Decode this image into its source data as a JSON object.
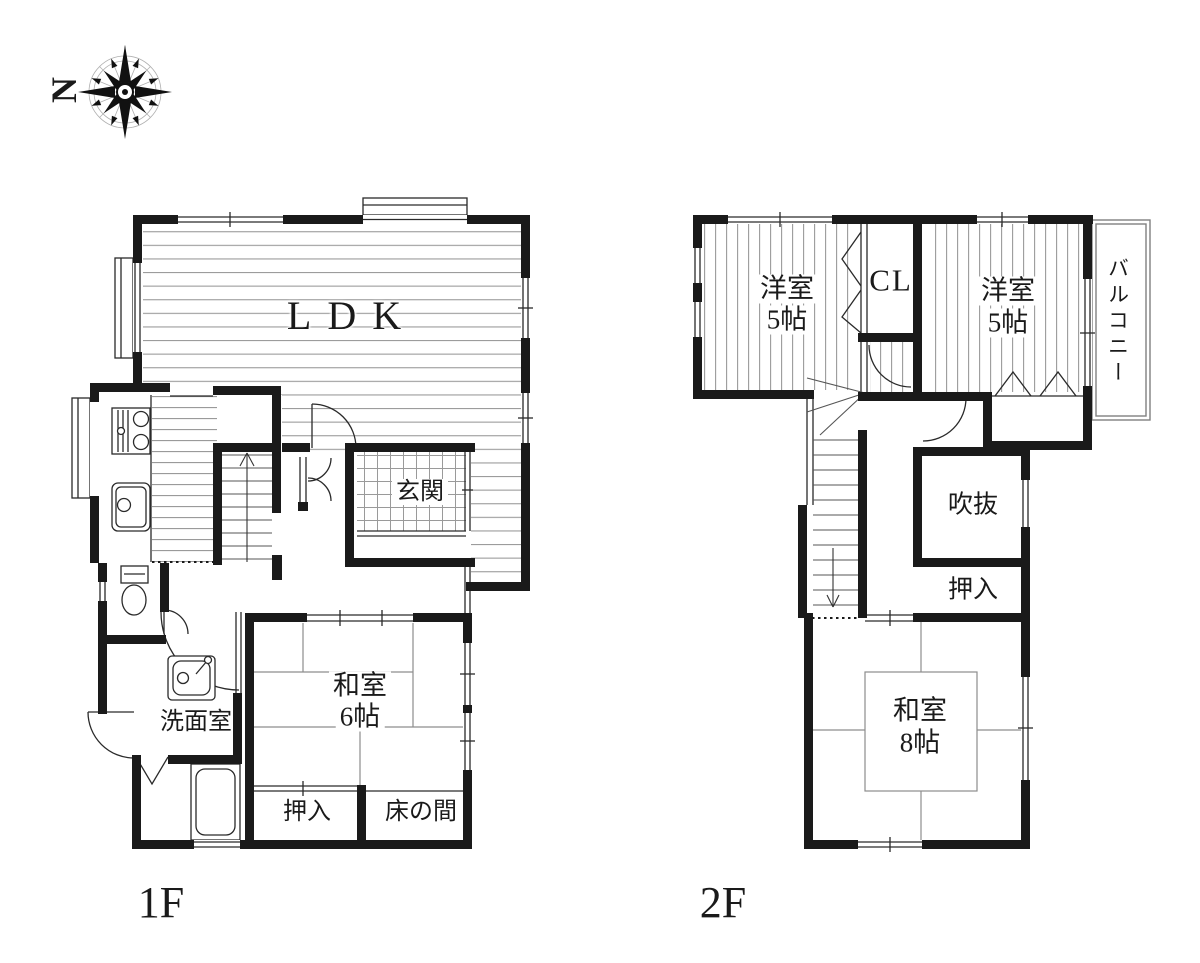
{
  "compass": {
    "north_label": "N"
  },
  "floor1": {
    "label": "1F",
    "rooms": {
      "ldk": "LDK",
      "genkan": "玄関",
      "washitsu_name": "和室",
      "washitsu_size": "6帖",
      "oshiire": "押入",
      "tokonoma": "床の間",
      "senmenshitsu": "洗面室"
    }
  },
  "floor2": {
    "label": "2F",
    "rooms": {
      "yoshitsu_left_name": "洋室",
      "yoshitsu_left_size": "5帖",
      "closet_top": "CL",
      "yoshitsu_right_name": "洋室",
      "yoshitsu_right_size": "5帖",
      "balcony": "バルコニー",
      "fukinuke": "吹抜",
      "oshiire": "押入",
      "washitsu_name": "和室",
      "washitsu_size": "8帖"
    }
  },
  "colors": {
    "wall": "#1a1a1a",
    "floor_line": "#9a9a9a",
    "thin_line": "#2a2a2a",
    "balcony_line": "#808080",
    "background": "#ffffff"
  }
}
